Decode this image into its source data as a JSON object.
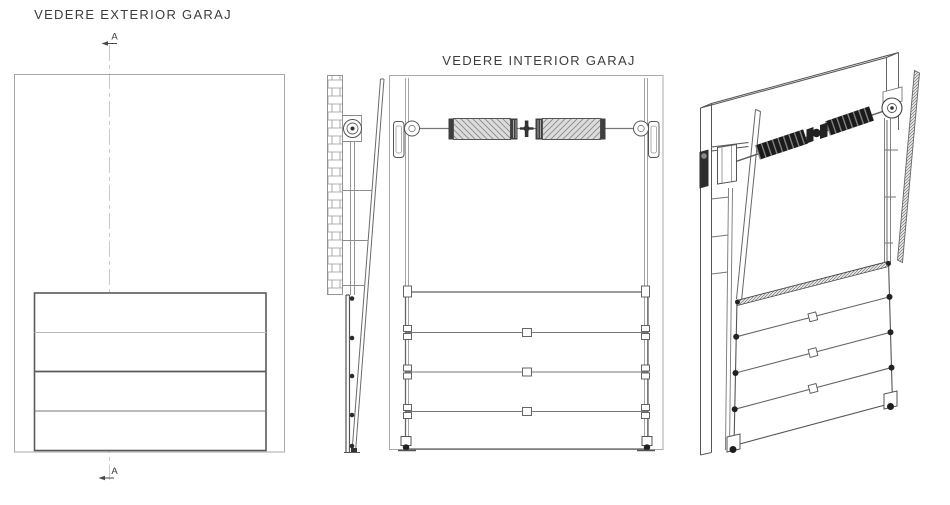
{
  "drawing": {
    "type": "technical-cad-drawing",
    "subject": "sectional garage door"
  },
  "colors": {
    "background": "#ffffff",
    "line_dark": "#4a4a4a",
    "line_mid": "#6e6e6e",
    "line_light": "#a8a8a8",
    "centerline": "#c9c9c9",
    "spring_fill": "#dcdcdc",
    "spring_hatch": "#8a8a8a",
    "spring_dark": "#1b1b1b",
    "hardware_dark": "#222222"
  },
  "views": {
    "exterior": {
      "title": "VEDERE EXTERIOR GARAJ",
      "marker_top": "A",
      "marker_bottom": "A",
      "panel_count": 4
    },
    "section": {
      "name": "side section A-A",
      "has_brick_wall": true,
      "roller_count": 5
    },
    "interior": {
      "title": "VEDERE INTERIOR GARAJ",
      "panel_count": 4,
      "torsion_springs": 2,
      "cable_drums": 2
    },
    "perspective": {
      "name": "3d interior perspective",
      "panel_count": 4,
      "torsion_springs": 2
    }
  }
}
